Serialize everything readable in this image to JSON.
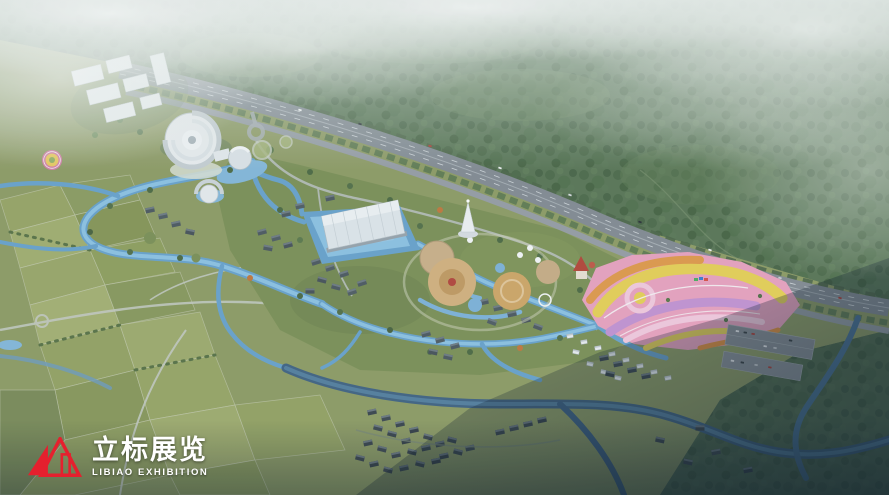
{
  "image": {
    "kind": "aerial architectural rendering",
    "subject": "tourism masterplan: misty forest hills, highway, wetland park, lake, exhibition buildings, theme park, flower sea, farmland and villages"
  },
  "logo": {
    "chinese": "立标展览",
    "english": "LIBIAO EXHIBITION",
    "mark_color": "#e5202e",
    "text_color": "#ffffff"
  },
  "scene": {
    "regions": [
      {
        "name": "misty-forest-hills",
        "color": "#5b7757"
      },
      {
        "name": "fog-haze",
        "color": "#ffffff"
      },
      {
        "name": "highway",
        "color": "#848c93"
      },
      {
        "name": "farmland-patchwork",
        "color": "#8f9c66"
      },
      {
        "name": "wetland-channels",
        "color": "#7fb3d8"
      },
      {
        "name": "central-lake",
        "color": "#8ec2e2"
      },
      {
        "name": "exhibition-hall",
        "color": "#dfe6ea"
      },
      {
        "name": "spiral-convention-center",
        "color": "#e9edef"
      },
      {
        "name": "white-campus-buildings",
        "color": "#edf1f2"
      },
      {
        "name": "white-pagoda",
        "color": "#eef1f3"
      },
      {
        "name": "theme-park-plazas",
        "color": "#d3b27f"
      },
      {
        "name": "flower-sea-base",
        "color": "#e8a3bf"
      },
      {
        "name": "flower-sea-band-yellow",
        "color": "#e6d058"
      },
      {
        "name": "flower-sea-band-orange",
        "color": "#e09a4c"
      },
      {
        "name": "flower-sea-band-purple",
        "color": "#c394d2"
      },
      {
        "name": "village-roofs",
        "color": "#4e5a61"
      },
      {
        "name": "shadow-village-roofs",
        "color": "#3d474f"
      },
      {
        "name": "evening-shadow",
        "color": "#0d1d2c"
      },
      {
        "name": "south-river",
        "color": "#3f6285"
      }
    ]
  }
}
